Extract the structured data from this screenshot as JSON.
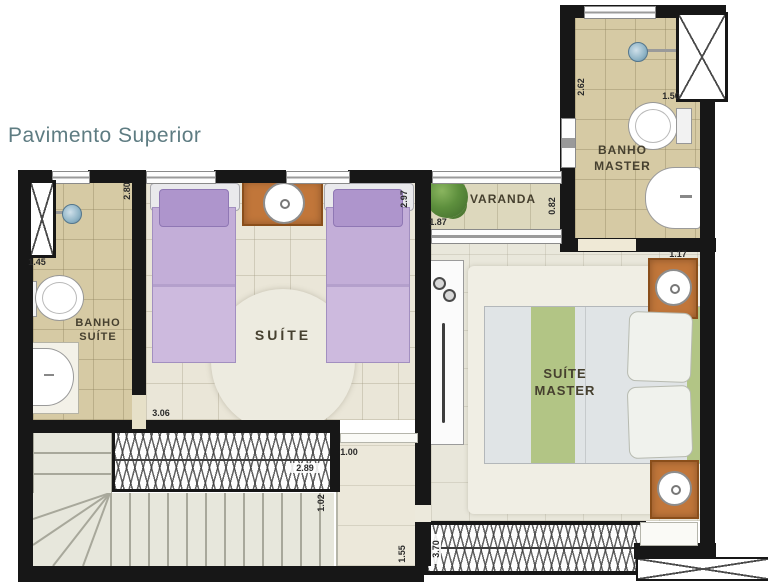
{
  "title": "Pavimento Superior",
  "rooms": {
    "banho_suite": {
      "name_line1": "BANHO",
      "name_line2": "SUÍTE"
    },
    "suite": {
      "name": "SUÍTE"
    },
    "varanda": {
      "name": "VARANDA"
    },
    "banho_master": {
      "name_line1": "BANHO",
      "name_line2": "MASTER"
    },
    "suite_master": {
      "name_line1": "SUÍTE",
      "name_line2": "MASTER"
    }
  },
  "dimensions": {
    "banho_suite_height": "2.80",
    "banho_suite_width": "1.45",
    "suite_height": "2.97",
    "suite_width": "3.06",
    "varanda_width": "1.87",
    "varanda_depth": "0.82",
    "banho_master_height": "2.62",
    "banho_master_width": "1.50",
    "master_nightstand": "1.17",
    "stair_opening": "2.89",
    "hall_width": "1.00",
    "hall_depth": "1.02",
    "hall_length": "1.55",
    "master_window": "3.70"
  },
  "icons": [
    "shower-head-icon",
    "toilet-icon",
    "sink-icon",
    "lamp-icon",
    "plant-icon",
    "bed-icon",
    "wardrobe-icon",
    "stairs-icon"
  ],
  "colors": {
    "wall": "#171717",
    "bath_floor": "#d6caa4",
    "suite_floor": "#eae6d8",
    "varanda_floor": "#ddd8bd",
    "master_floor": "#e9e7db",
    "accent_wood": "#c1763a",
    "bed_lavender": "#c3aed8",
    "bed_green": "#b2c585",
    "title_text": "#5e7c82"
  }
}
